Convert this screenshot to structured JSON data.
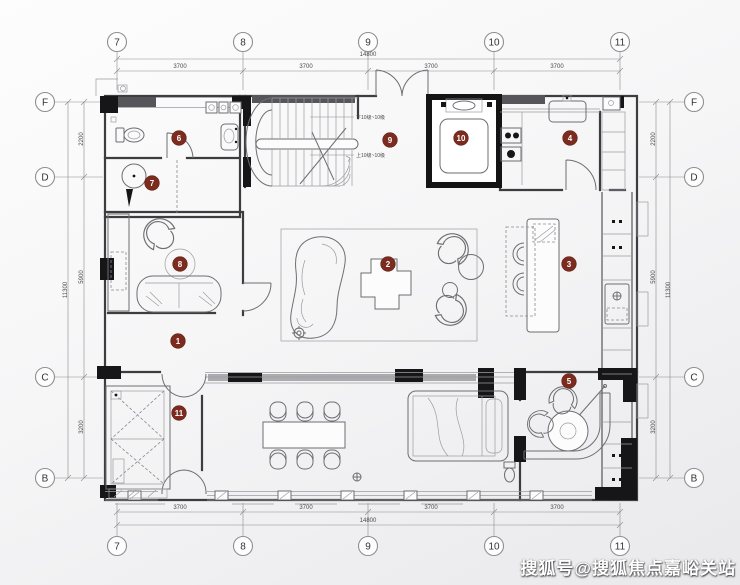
{
  "watermark": "搜狐号@搜狐焦点嘉峪关站",
  "grid": {
    "columns": [
      {
        "label": "7"
      },
      {
        "label": "8"
      },
      {
        "label": "9"
      },
      {
        "label": "10"
      },
      {
        "label": "11"
      }
    ],
    "rows": [
      {
        "label": "F"
      },
      {
        "label": "D"
      },
      {
        "label": "C"
      },
      {
        "label": "B"
      }
    ]
  },
  "dimensions": {
    "horizontal": {
      "total": "14800",
      "segments": [
        "3700",
        "3700",
        "3700",
        "3700"
      ]
    },
    "vertical": {
      "total": "11300",
      "segments": [
        "2200",
        "5900",
        "3200"
      ]
    }
  },
  "stairs": {
    "note_upper": "下10级~10级",
    "note_lower": "上10级~10级"
  },
  "markers": [
    {
      "num": "1"
    },
    {
      "num": "2"
    },
    {
      "num": "3"
    },
    {
      "num": "4"
    },
    {
      "num": "5"
    },
    {
      "num": "6"
    },
    {
      "num": "7"
    },
    {
      "num": "8"
    },
    {
      "num": "9"
    },
    {
      "num": "10"
    },
    {
      "num": "11"
    }
  ],
  "colors": {
    "marker_red": "#7c2b1e",
    "wall_dark": "#3d3d40",
    "watermark_text": "#ffffff"
  }
}
